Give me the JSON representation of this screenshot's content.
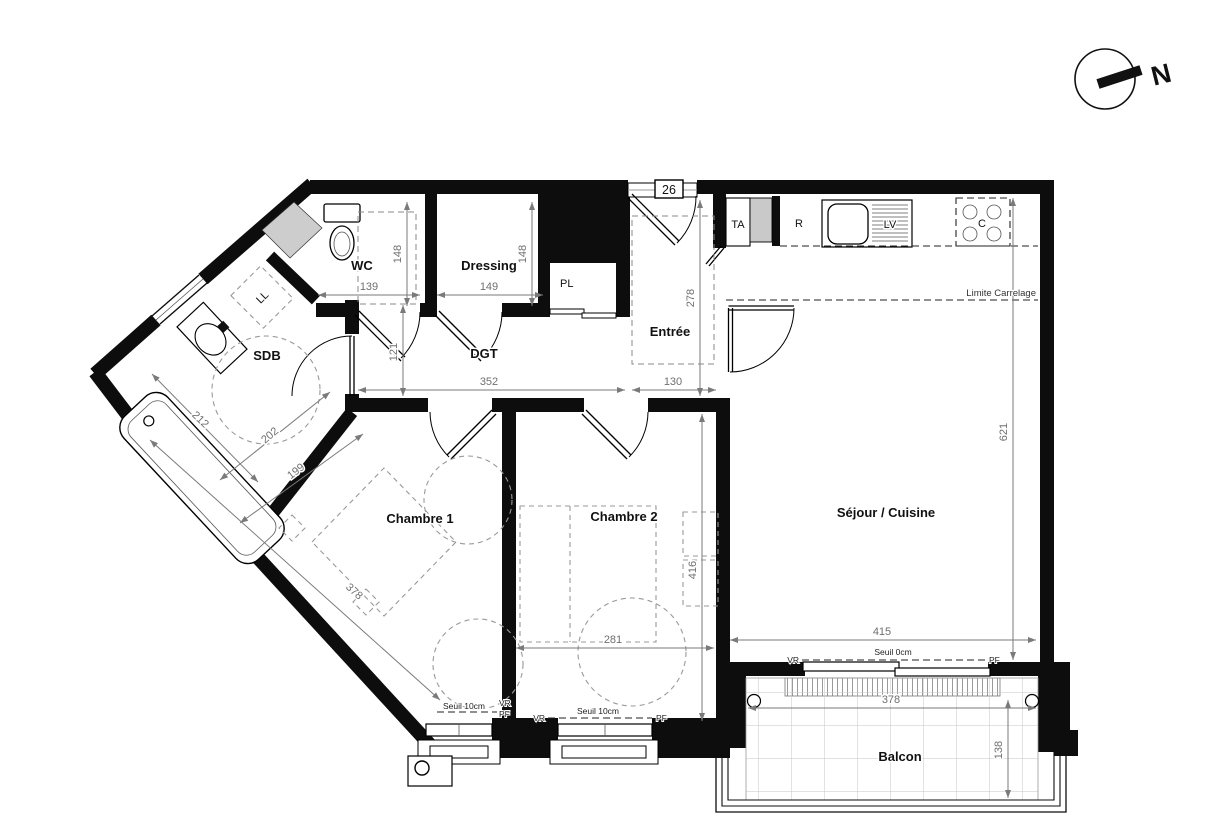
{
  "plan": {
    "unit_number": "26",
    "north_label": "N",
    "rooms": {
      "wc": "WC",
      "dressing": "Dressing",
      "placard": "PL",
      "sdb": "SDB",
      "dgt": "DGT",
      "entree": "Entrée",
      "chambre1": "Chambre 1",
      "chambre2": "Chambre 2",
      "sejour": "Séjour / Cuisine",
      "balcon": "Balcon"
    },
    "equipment": {
      "lave_linge": "LL",
      "tableau": "TA",
      "refrigerateur": "R",
      "lave_vaisselle": "LV",
      "cuisson": "C"
    },
    "notes": {
      "limite_carrelage": "Limite Carrelage",
      "seuil_0": "Seuil 0cm",
      "seuil_10": "Seuil 10cm",
      "volet_roulant": "VR",
      "porte_fenetre": "PF"
    },
    "dims": {
      "wc_w": "139",
      "wc_h": "148",
      "dressing_w": "149",
      "dressing_h": "148",
      "dgt_h": "121",
      "dgt_w": "352",
      "entree_w": "130",
      "entree_h": "278",
      "sdb_l": "212",
      "sdb_w": "202",
      "ch1_w": "199",
      "ch1_l": "378",
      "ch2_w": "281",
      "ch2_h": "416",
      "sejour_h": "621",
      "sejour_w": "415",
      "balcon_w": "378",
      "balcon_d": "138"
    }
  }
}
